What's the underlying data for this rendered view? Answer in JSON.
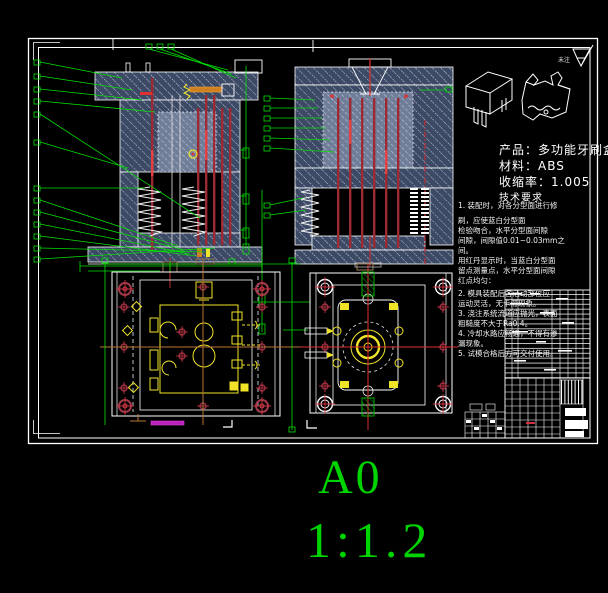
{
  "sheet": {
    "format": "A0",
    "scale": "1:1.2"
  },
  "product_info": {
    "product_label": "产品：多功能牙刷盒",
    "material_label": "材料：ABS",
    "shrinkage_label": "收缩率：1.005",
    "tech_req_header": "技术要求"
  },
  "surface_finish_note": "未注",
  "tech_notes": {
    "lines": [
      "1. 装配时，对各分型面进行修",
      "刷，应使蓝白分型面",
      "检验吻合，水平分型面间隙",
      "间隙，间隙值0.01~0.03mm之",
      "间。",
      "用红丹显示时，当蓝白分型面",
      "留点测量点，水平分型面间隙",
      "红点均匀：",
      "2. 模具装配后各活动部位应",
      "运动灵活，无卡滞现象。",
      "3. 浇注系统流道应抛光，表面",
      "粗糙度不大于Ra0.4。",
      "4. 冷却水路应畅通，不得有渗",
      "漏现象。",
      "5. 试模合格后方可交付使用。"
    ]
  },
  "colors": {
    "background": "#000000",
    "line_white": "#ffffff",
    "callout_green": "#00e000",
    "pin_red": "#b02a32",
    "bright_red": "#e03030",
    "detail_yellow": "#f0e428",
    "centerline_orange": "#b87333",
    "highlight_magenta": "#bb22bb",
    "sheet_text_green": "#00d400",
    "hatch_fill_dark": "#3d4a66",
    "hatch_fill_light": "#707e9a"
  }
}
